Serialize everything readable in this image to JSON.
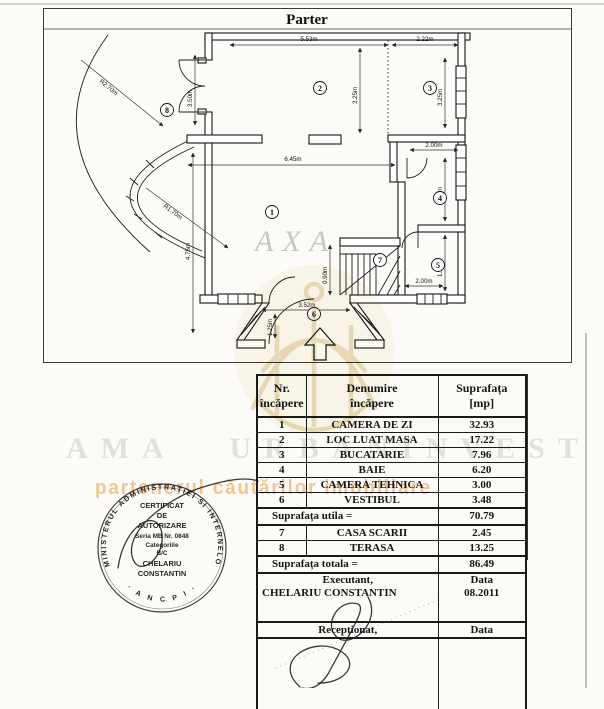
{
  "page": {
    "title": "Parter"
  },
  "plan": {
    "dims": {
      "room2_width": "5.53m",
      "room3_width": "2.22m",
      "terrace_door_height": "3.50m",
      "room2_depth": "3.25m",
      "room3_depth": "3.25m",
      "room1_width": "6.45m",
      "room4_width": "2.00m",
      "room4_depth": "3.10m",
      "room5_depth": "1.50m",
      "room5_width": "2.00m",
      "room1_depth": "4.75m",
      "radius_outer": "R2.70m",
      "radius_inner": "R1.70m",
      "stair_passage": "0.90m",
      "vestibul_width": "3.52m",
      "vestibul_depth": "1.25m"
    },
    "rooms": {
      "r1": "1",
      "r2": "2",
      "r3": "3",
      "r4": "4",
      "r5": "5",
      "r6": "6",
      "r7": "7",
      "r8": "8"
    }
  },
  "watermarks": {
    "axa": "AXA",
    "line1": "AMA URBANINVEST",
    "line2": "partenerul căutărilor imobiliare"
  },
  "table": {
    "headers": {
      "col1a": "Nr.",
      "col1b": "încăpere",
      "col2a": "Denumire",
      "col2b": "încăpere",
      "col3a": "Suprafața",
      "col3b": "[mp]"
    },
    "rows": [
      {
        "nr": "1",
        "name": "CAMERA DE ZI",
        "mp": "32.93"
      },
      {
        "nr": "2",
        "name": "LOC LUAT MASA",
        "mp": "17.22"
      },
      {
        "nr": "3",
        "name": "BUCATARIE",
        "mp": "7.96"
      },
      {
        "nr": "4",
        "name": "BAIE",
        "mp": "6.20"
      },
      {
        "nr": "5",
        "name": "CAMERA TEHNICA",
        "mp": "3.00"
      },
      {
        "nr": "6",
        "name": "VESTIBUL",
        "mp": "3.48"
      },
      {
        "nr": "7",
        "name": "CASA SCARII",
        "mp": "2.45"
      },
      {
        "nr": "8",
        "name": "TERASA",
        "mp": "13.25"
      }
    ],
    "subtotal_label": "Suprafața utila  =",
    "subtotal_value": "70.79",
    "total_label": "Suprafața totala  =",
    "total_value": "86.49",
    "executant_label": "Executant,",
    "executant_name": "CHELARIU CONSTANTIN",
    "executant_data_label": "Data",
    "executant_date": "08.2011",
    "receptionat_label": "Recepționat,",
    "receptionat_data_label": "Data"
  },
  "stamp": {
    "ring_text": "MINISTERUL ADMINISTRATIEI SI INTERNELOR",
    "bottom_text": "· A N C P I ·",
    "line1": "CERTIFICAT",
    "line2": "DE",
    "line3": "AUTORIZARE",
    "line4": "Seria MB Nr. 0848",
    "line5": "Categoriile",
    "line6": "B/C",
    "line7": "CHELARIU",
    "line8": "CONSTANTIN"
  },
  "colors": {
    "ink": "#1a1a1a",
    "watermark_gray": "#9a9a9a",
    "watermark_gold": "#c49b3f",
    "watermark_orange": "#e8922e"
  }
}
